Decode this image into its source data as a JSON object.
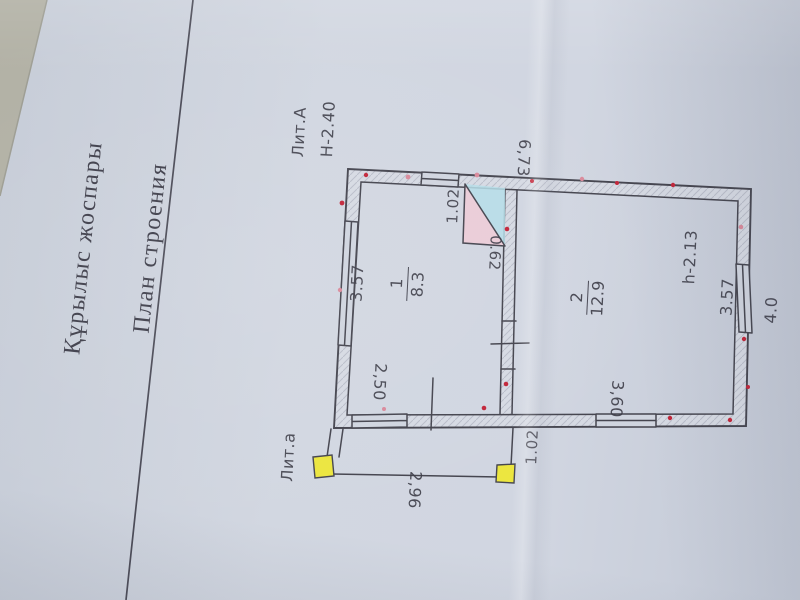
{
  "titles": {
    "kk": "Құрылыс жоспары",
    "ru": "План строения"
  },
  "labels": {
    "liter_main": "Лит.А",
    "building_height": "Н-2.40",
    "liter_porch": "Лит.а",
    "room_height": "h-2.13"
  },
  "dimensions": {
    "top_width": "6,73",
    "right_depth": "4.0",
    "room1_side": "3.57",
    "room1_bottom": "2,50",
    "room2_side": "3.57",
    "room2_bottom": "3,60",
    "stove_width": "1.02",
    "stove_depth": "0.62",
    "porch_width": "2,96",
    "porch_side": "1.02"
  },
  "rooms": [
    {
      "number": "1",
      "area": "8.3"
    },
    {
      "number": "2",
      "area": "12.9"
    }
  ],
  "colors": {
    "paper": "#d0d5df",
    "surface": "#b2b1a5",
    "ink": "#45454f",
    "ink_soft": "#3d3d48",
    "red_dot": "#c2263a",
    "pink_dot": "#d астор"
  }
}
